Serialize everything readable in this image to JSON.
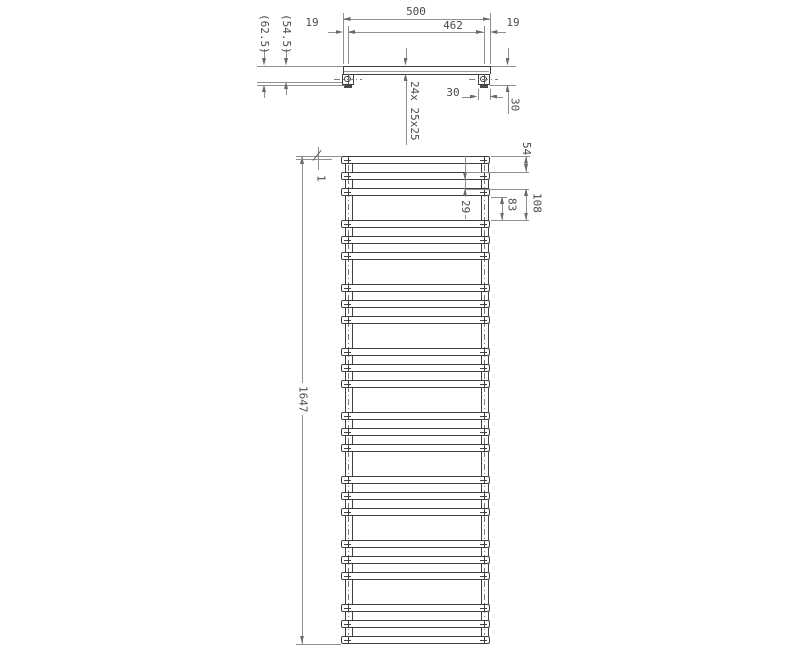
{
  "document": {
    "type": "technical dimension drawing",
    "subject": "wall-mounted flat-rail towel radiator, top view and front view"
  },
  "colors": {
    "background": "#ffffff",
    "object_line": "#3f3f3f",
    "dimension_line": "#8f8f8f",
    "arrow": "#6a6a6a",
    "text": "#4a4a4a"
  },
  "views": {
    "top_view": {
      "name": "top view (plan)",
      "features": [
        "radiator bar",
        "left wall bracket",
        "right wall bracket"
      ]
    },
    "front_view": {
      "name": "front view (elevation)",
      "features": [
        "24 flat rails in 8 groups of 3",
        "two vertical collector tubes"
      ]
    }
  },
  "drawing_spec": {
    "total_rails": 24,
    "rail_groups": 8,
    "rails_per_group": 3,
    "rail_profile_note": "24x 25x25"
  },
  "dimensions": [
    {
      "id": "width-overall",
      "text": "500"
    },
    {
      "id": "width-centers",
      "text": "462"
    },
    {
      "id": "offset-left",
      "text": "19"
    },
    {
      "id": "offset-right",
      "text": "19"
    },
    {
      "id": "depth-overall",
      "text": "(62.5)"
    },
    {
      "id": "depth-centers",
      "text": "(54.5)"
    },
    {
      "id": "bracket-width",
      "text": "30"
    },
    {
      "id": "bracket-depth",
      "text": "30"
    },
    {
      "id": "rail-spec",
      "text": "24x 25x25"
    },
    {
      "id": "top-offset",
      "text": "1"
    },
    {
      "id": "rail-pitch",
      "text": "54"
    },
    {
      "id": "group-pitch",
      "text": "108"
    },
    {
      "id": "group-gap",
      "text": "83"
    },
    {
      "id": "rail-gap",
      "text": "29"
    },
    {
      "id": "height-overall",
      "text": "1647"
    }
  ]
}
